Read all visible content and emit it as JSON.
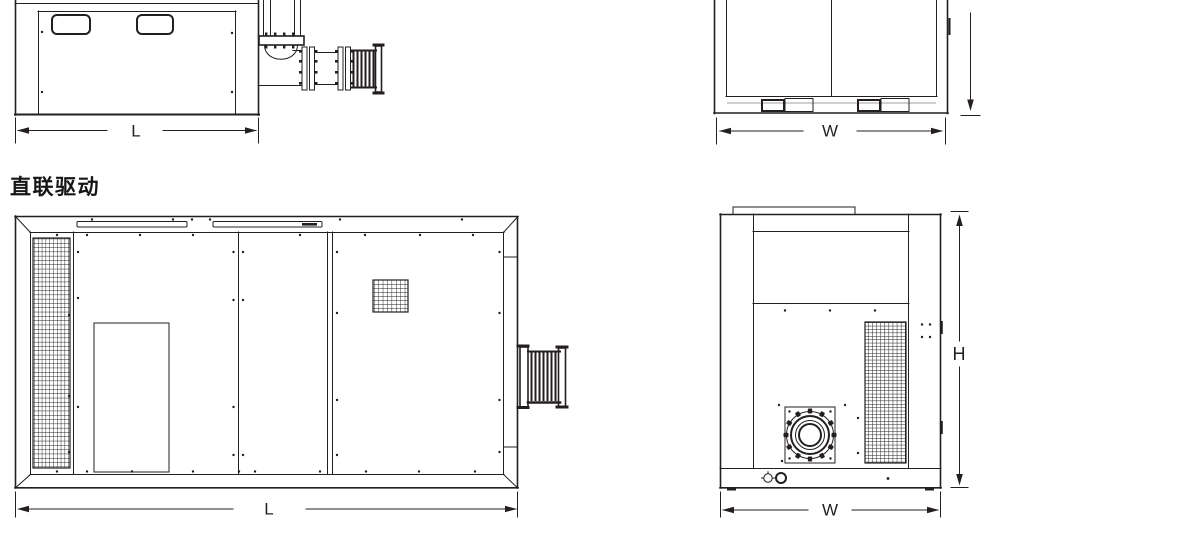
{
  "page": {
    "background_color": "#ffffff",
    "line_color": "#231f20",
    "label_text_color": "#161616"
  },
  "sections": {
    "direct_drive": {
      "title": "直联驱动"
    }
  },
  "dimension_labels": {
    "top_side_view_length": "L",
    "top_front_view_width": "W",
    "direct_drive_side_view_length": "L",
    "direct_drive_front_view_width": "W",
    "direct_drive_front_view_height": "H"
  }
}
